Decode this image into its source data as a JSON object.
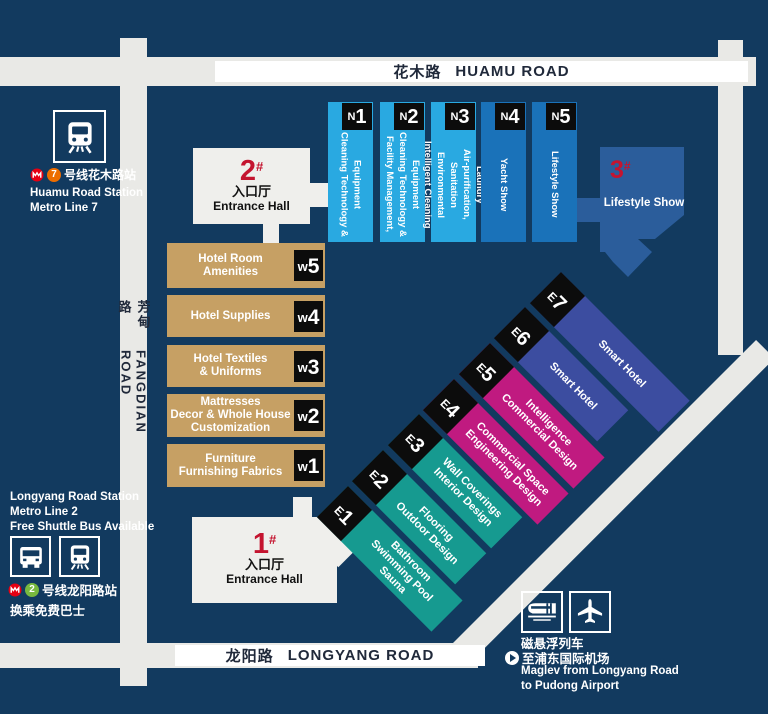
{
  "colors": {
    "background": "#123a5f",
    "road": "#e9e9e6",
    "hall_n_light": "#29a9e1",
    "hall_n_dark": "#1a72b9",
    "hall_w_tan": "#c6a064",
    "hall_e_teal": "#169a90",
    "hall_e_magenta": "#c01a80",
    "hall_e_indigo": "#3c4da0",
    "hall_3_blue": "#2b5d9b",
    "entrance_red": "#c4142f",
    "label_box_black": "#0c0c0c",
    "metro_logo_red": "#e60012",
    "line7_orange": "#ed6d00",
    "line2_green": "#78b93e"
  },
  "roads": {
    "huamu": {
      "cn": "花木路",
      "en": "HUAMU ROAD"
    },
    "fangdian": {
      "cn": "芳甸路",
      "en": "FANGDIAN ROAD"
    },
    "longyang": {
      "cn": "龙阳路",
      "en": "LONGYANG ROAD"
    }
  },
  "entrance_2": {
    "num": "2",
    "hash": "#",
    "cn": "入口厅",
    "en": "Entrance Hall"
  },
  "entrance_1": {
    "num": "1",
    "hash": "#",
    "cn": "入口厅",
    "en": "Entrance Hall"
  },
  "hall_3": {
    "num": "3",
    "hash": "#",
    "label": "Lifestyle Show"
  },
  "halls_n": [
    {
      "prefix": "N",
      "num": "1",
      "label": "Cleaning Technology &\nEquipment"
    },
    {
      "prefix": "N",
      "num": "2",
      "label": "Facility Management,\nCleaning Technology &\nEquipment"
    },
    {
      "prefix": "N",
      "num": "3",
      "label": "Intelligent Cleaning\nEnvironmental Sanitation\nAir-purification, Laundry"
    },
    {
      "prefix": "N",
      "num": "4",
      "label": "Yacht Show"
    },
    {
      "prefix": "N",
      "num": "5",
      "label": "Lifestyle Show"
    }
  ],
  "halls_w": [
    {
      "prefix": "W",
      "num": "5",
      "label": "Hotel Room\nAmenities"
    },
    {
      "prefix": "W",
      "num": "4",
      "label": "Hotel Supplies"
    },
    {
      "prefix": "W",
      "num": "3",
      "label": "Hotel Textiles\n& Uniforms"
    },
    {
      "prefix": "W",
      "num": "2",
      "label": "Mattresses\nDecor & Whole House\nCustomization"
    },
    {
      "prefix": "W",
      "num": "1",
      "label": "Furniture\nFurnishing Fabrics"
    }
  ],
  "halls_e": [
    {
      "prefix": "E",
      "num": "1",
      "label": "Bathroom\nSwimming Pool\nSauna"
    },
    {
      "prefix": "E",
      "num": "2",
      "label": "Flooring\nOutdoor Design"
    },
    {
      "prefix": "E",
      "num": "3",
      "label": "Wall Coverings\nInterior Design"
    },
    {
      "prefix": "E",
      "num": "4",
      "label": "Commercial Space\nEngineering Design"
    },
    {
      "prefix": "E",
      "num": "5",
      "label": "Intelligence\nCommercial Design"
    },
    {
      "prefix": "E",
      "num": "6",
      "label": "Smart Hotel"
    },
    {
      "prefix": "E",
      "num": "7",
      "label": "Smart Hotel"
    }
  ],
  "station_huamu": {
    "line_badge": "7",
    "cn": "号线花木路站",
    "en": "Huamu Road Station\nMetro Line 7"
  },
  "station_longyang": {
    "en": "Longyang Road Station\nMetro Line 2\nFree Shuttle Bus Available",
    "line_badge": "2",
    "cn_station": "号线龙阳路站",
    "cn_shuttle": "换乘免费巴士"
  },
  "maglev": {
    "cn_title": "磁悬浮列车",
    "cn_dest": "至浦东国际机场",
    "en": "Maglev from Longyang Road\nto Pudong Airport"
  }
}
